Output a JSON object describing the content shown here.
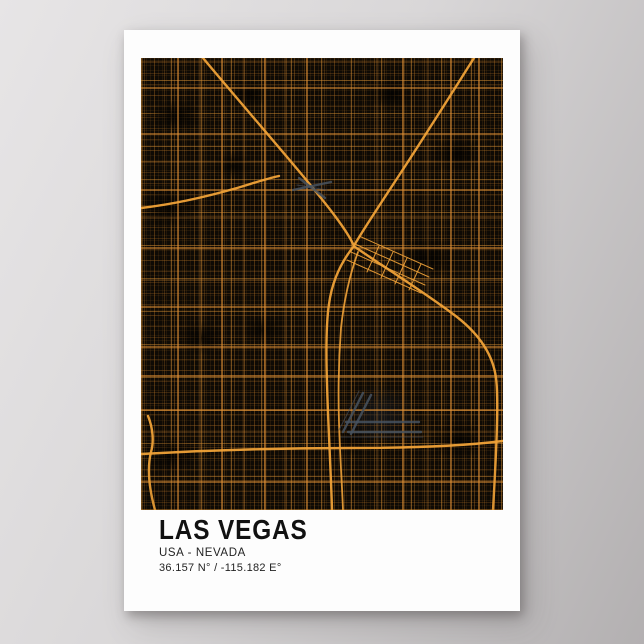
{
  "theme": {
    "wall-top": "#e7e5e6",
    "wall-bottom": "#b3b0b1",
    "poster-bg": "#fdfdfd",
    "map-bg": "#0e0a05",
    "road-major": "#e09136",
    "road-highway": "#f0a238",
    "airport-gray": "#47525f",
    "title-color": "#111111",
    "subtitle-color": "#232323"
  },
  "poster": {
    "title": "LAS VEGAS",
    "subtitle": "USA - NEVADA",
    "coordinates": "36.157 N° / -115.182 E°"
  },
  "map": {
    "description": "Dark street map of Las Vegas with orange road network",
    "landmark_icons": [
      "harry-reid-airport-runways-icon",
      "north-las-vegas-airport-icon",
      "downtown-diagonal-grid",
      "i-15-highway",
      "us-95-highway",
      "215-beltway",
      "las-vegas-strip-road"
    ]
  }
}
